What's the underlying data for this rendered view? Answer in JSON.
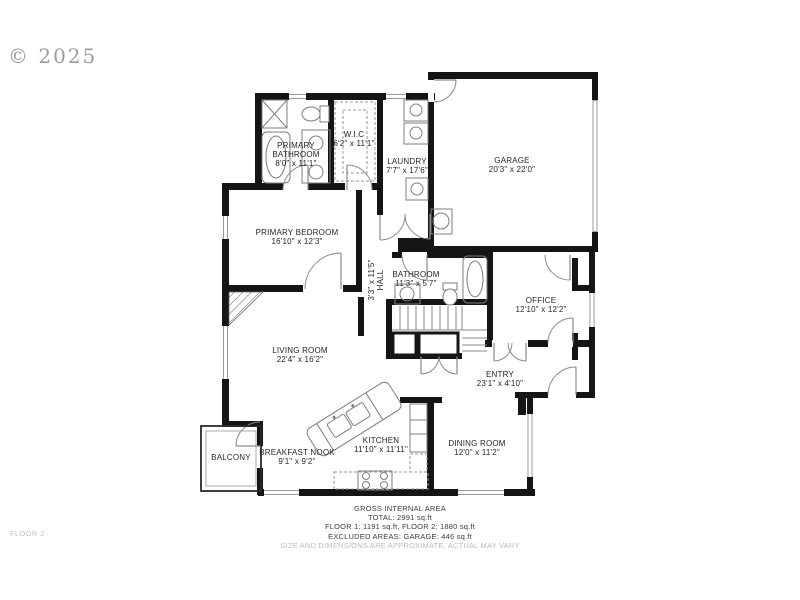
{
  "page": {
    "copyright": "© 2025",
    "floor_label": "FLOOR 2"
  },
  "rooms": [
    {
      "name": "PRIMARY BATHROOM",
      "dims": "8'0\" x 11'1\""
    },
    {
      "name": "W.I.C",
      "dims": "6'2\" x 11'1\""
    },
    {
      "name": "LAUNDRY",
      "dims": "7'7\" x 17'6\""
    },
    {
      "name": "GARAGE",
      "dims": "20'3\" x 22'0\""
    },
    {
      "name": "PRIMARY BEDROOM",
      "dims": "16'10\" x 12'3\""
    },
    {
      "name": "HALL",
      "dims": "3'3\" x 11'5\""
    },
    {
      "name": "BATHROOM",
      "dims": "11'3\" x 5'7\""
    },
    {
      "name": "OFFICE",
      "dims": "12'10\" x 12'2\""
    },
    {
      "name": "LIVING ROOM",
      "dims": "22'4\" x 16'2\""
    },
    {
      "name": "ENTRY",
      "dims": "23'1\" x 4'10\""
    },
    {
      "name": "DINING ROOM",
      "dims": "12'0\" x 11'2\""
    },
    {
      "name": "KITCHEN",
      "dims": "11'10\" x 11'11\""
    },
    {
      "name": "BREAKFAST NOOK",
      "dims": "9'1\" x 9'2\""
    },
    {
      "name": "BALCONY",
      "dims": ""
    }
  ],
  "footer": {
    "title": "GROSS INTERNAL AREA",
    "total": "TOTAL: 2991 sq.ft",
    "floors": "FLOOR 1: 1191 sq.ft, FLOOR 2: 1880 sq.ft",
    "excluded": "EXCLUDED AREAS: GARAGE: 446 sq.ft",
    "disclaimer": "SIZE AND DIMENSIONS ARE APPROXIMATE, ACTUAL MAY VARY"
  }
}
